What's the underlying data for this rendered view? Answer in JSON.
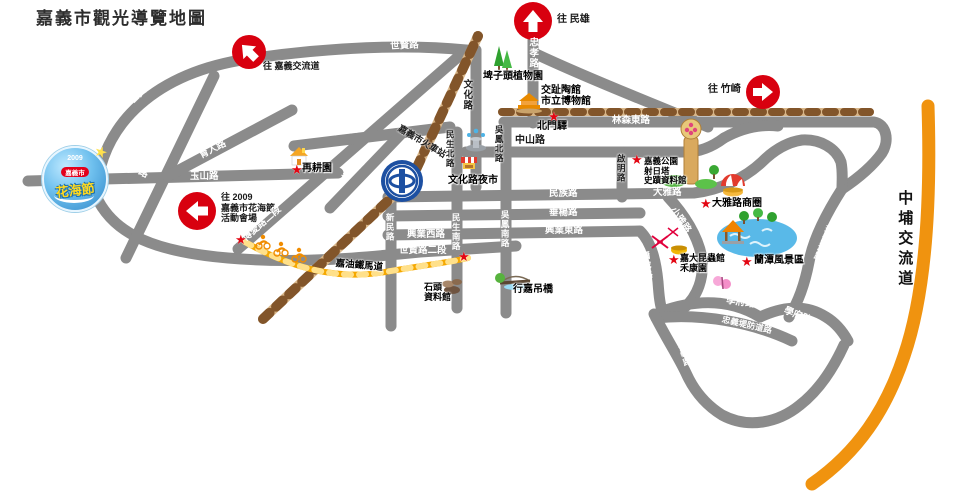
{
  "title": "嘉義市觀光導覽地圖",
  "icons": {
    "star": "★",
    "sparkle": "★"
  },
  "colors": {
    "road": "#8b8b8b",
    "rail_light": "#d8b689",
    "rail_dark": "#82552a",
    "bike_path": "#f5a800",
    "highway": "#f0930f",
    "badge": "#d8000f",
    "star": "#e30613"
  },
  "map": {
    "arrows": {
      "chiayi_interchange": {
        "label": "往 嘉義交流道"
      },
      "minxiong": {
        "label": "往 民雄"
      },
      "zhuqi": {
        "label": "往 竹崎"
      },
      "flower_festival": {
        "line1": "往 2009",
        "line2": "嘉義市花海節",
        "line3": "活動會場"
      }
    },
    "festival_logo": {
      "year": "2009",
      "city": "嘉義市",
      "name": "花海節"
    },
    "highway_label": "中埔交流道",
    "roads": {
      "shixian_top": "世賢路",
      "shixian_left": "世賢路",
      "yushan": "玉山路",
      "datong": "大同路",
      "yuren": "育人路",
      "boai_1": "博愛路一段",
      "boai_2": "博愛路二段",
      "zhongxing_st": "中興街",
      "beixing_st": "北興街",
      "wenhua": "文化路",
      "zhongxiao": "忠孝路",
      "linsen_e": "林森東路",
      "zhongshan": "中山路",
      "minsheng_n": "民生北路",
      "wufeng_n": "吳鳳北路",
      "qiming": "啟明路",
      "minzu": "民族路",
      "chuiyang": "垂楊路",
      "xingye_e": "興業東路",
      "xingye_w": "興業西路",
      "shixian_2": "世賢路二段",
      "xinmin": "新民路",
      "minsheng_s": "民生南路",
      "wufeng_s": "吳鳳南路",
      "daya": "大雅路",
      "xiaoya": "小雅路",
      "mituo": "彌陀路",
      "xuefu_w": "學府路",
      "xuefu_e": "學府路",
      "zhongyi_levee": "忠義堤防道路",
      "zhongyi": "忠義路",
      "huantan": "環潭道路",
      "station": "嘉義市火車站"
    },
    "pois": {
      "pizitou": "埤子頭植物園",
      "koji_1": "交趾陶館",
      "koji_2": "市立博物館",
      "beimen": "北門驛",
      "night_market": "文化路夜市",
      "zaigeng": "再耕園",
      "park_1": "嘉義公園",
      "park_2": "射日塔",
      "park_3": "史蹟資料館",
      "daya_biz": "大雅路商圈",
      "lantan": "蘭潭風景區",
      "insect_1": "嘉大昆蟲館",
      "insect_2": "禾康園",
      "stone_1": "石頭",
      "stone_2": "資料館",
      "xingjia_bridge": "行嘉吊橋",
      "bike_path": "嘉油鐵馬道"
    }
  }
}
